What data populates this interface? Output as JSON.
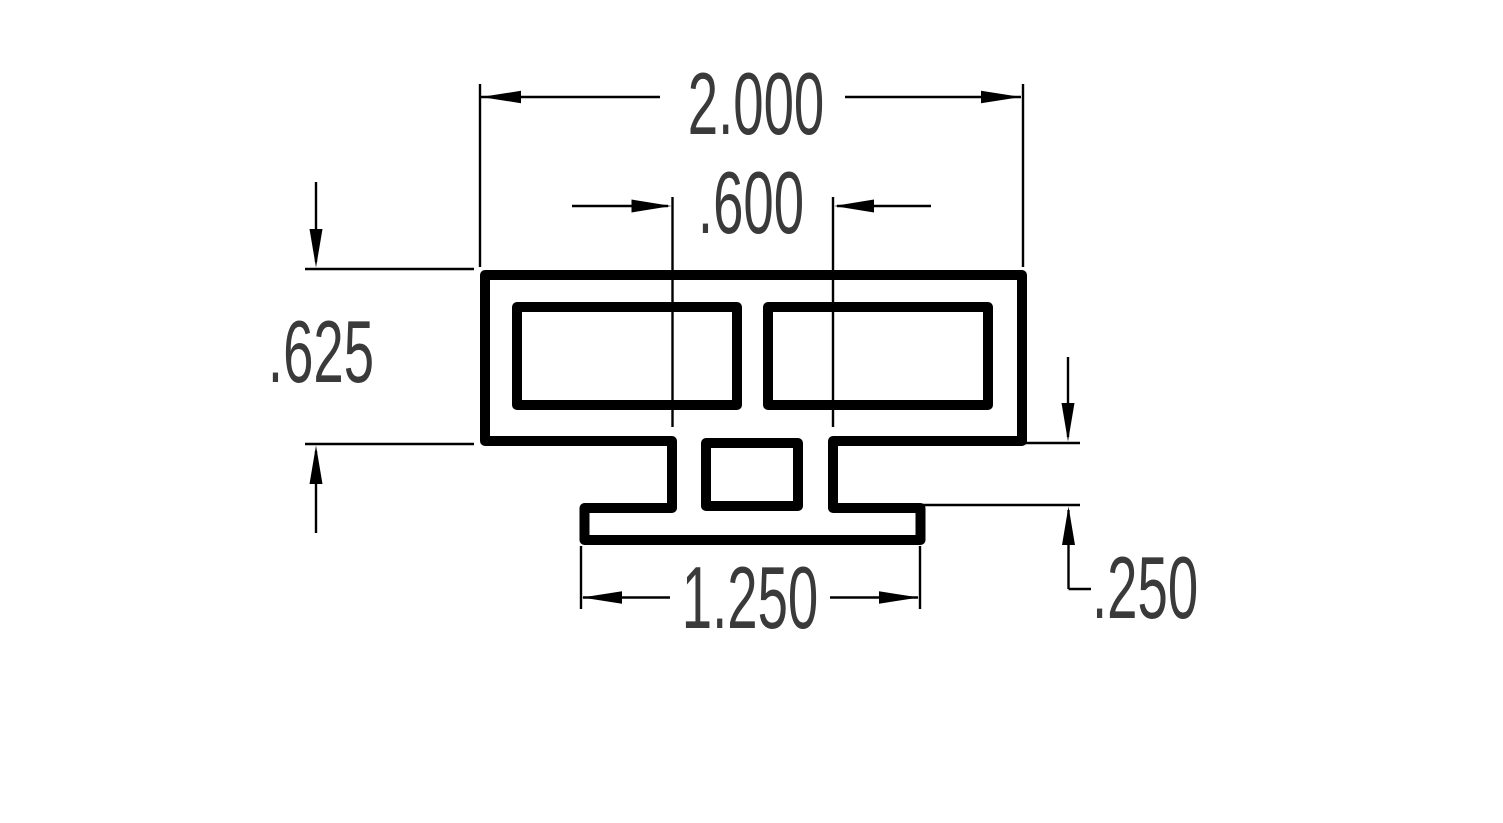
{
  "drawing": {
    "dimension_labels": {
      "overall_width": "2.000",
      "stem_width": ".600",
      "body_height": ".625",
      "base_width": "1.250",
      "stem_height": ".250"
    },
    "colors": {
      "line": "#000000",
      "dimension_text": "#3a3a3a",
      "background": "#ffffff"
    }
  }
}
